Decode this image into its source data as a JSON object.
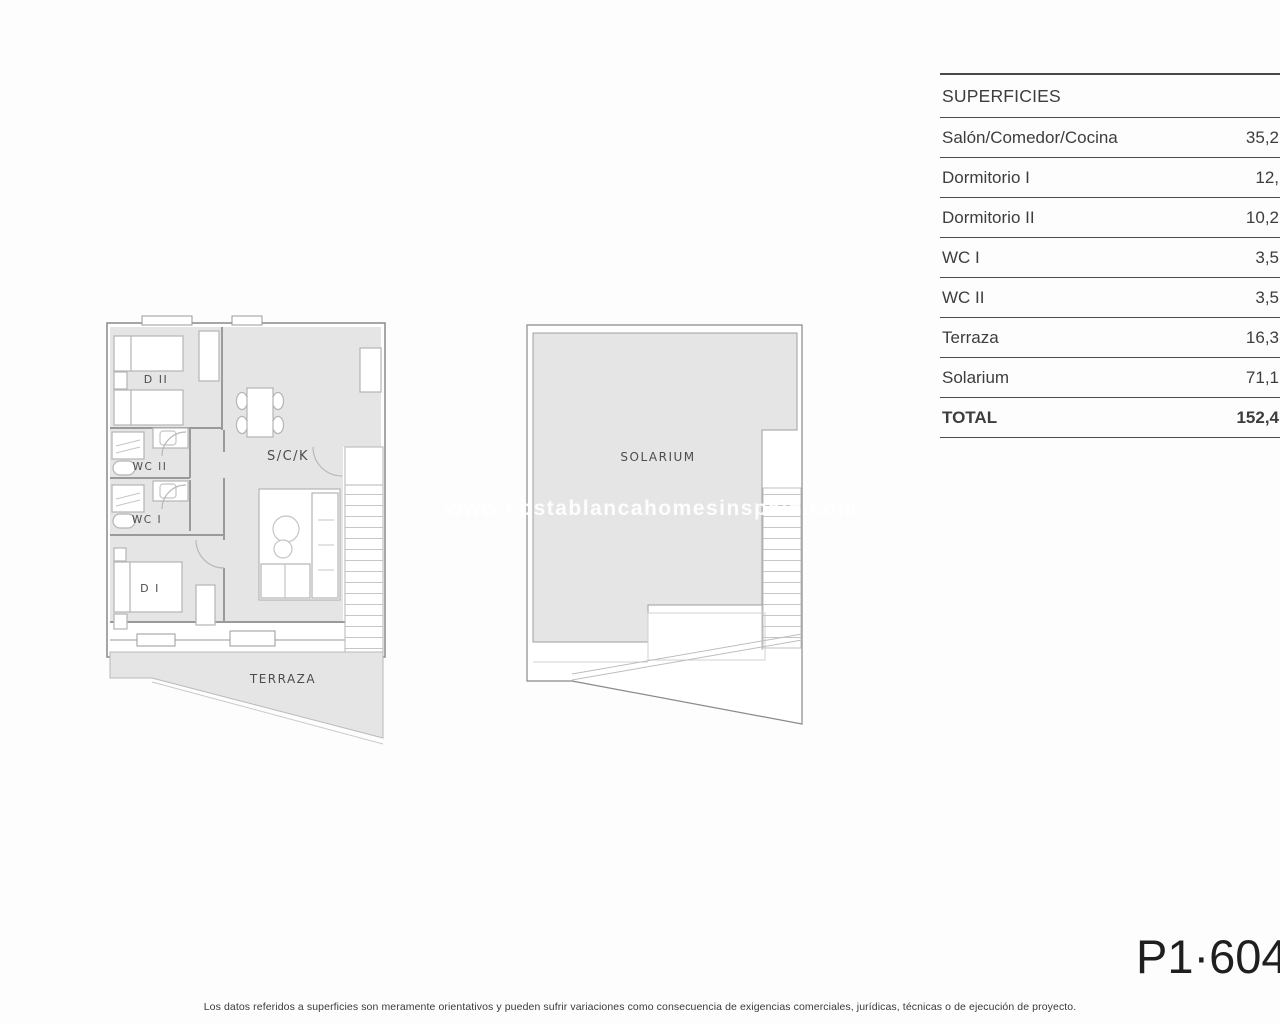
{
  "page": {
    "watermark": "www.costablancahomesinspain.com",
    "plan_code": "P1·604",
    "disclaimer": "Los datos referidos a superficies son meramente orientativos y pueden sufrir variaciones como consecuencia de exigencias comerciales, jurídicas, técnicas o de ejecución de proyecto."
  },
  "surfaces_table": {
    "title": "SUPERFICIES",
    "rows": [
      {
        "label": "Salón/Comedor/Cocina",
        "value": "35,2"
      },
      {
        "label": "Dormitorio I",
        "value": "12,"
      },
      {
        "label": "Dormitorio II",
        "value": "10,2"
      },
      {
        "label": "WC I",
        "value": "3,5"
      },
      {
        "label": "WC II",
        "value": "3,5"
      },
      {
        "label": "Terraza",
        "value": "16,3"
      },
      {
        "label": "Solarium",
        "value": "71,1"
      }
    ],
    "total": {
      "label": "TOTAL",
      "value": "152,4"
    }
  },
  "plans": {
    "apartment": {
      "rooms": {
        "d2": "D II",
        "wc2": "WC II",
        "wc1": "WC I",
        "d1": "D I",
        "sck": "S/C/K",
        "terraza": "TERRAZA"
      }
    },
    "solarium": {
      "label": "SOLARIUM"
    }
  },
  "colors": {
    "floor_fill": "#e5e5e5",
    "wall_line": "#9a9a9a",
    "furniture_line": "#b5b5b5",
    "table_line": "#4a4a4a",
    "text": "#3d3d3d"
  }
}
